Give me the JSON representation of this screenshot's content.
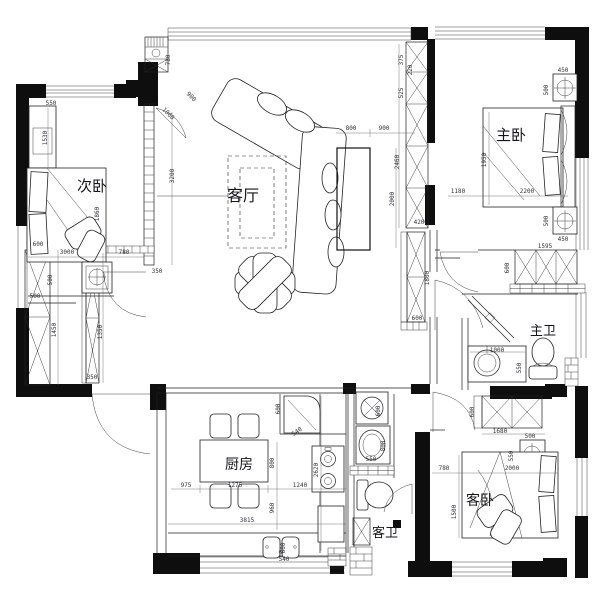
{
  "floorplan": {
    "drawing_type": "apartment-floor-plan",
    "rooms": [
      {
        "id": "ciwo",
        "label": "次卧",
        "x": 92,
        "y": 191,
        "size": 15
      },
      {
        "id": "keting",
        "label": "客厅",
        "x": 243,
        "y": 201,
        "size": 16
      },
      {
        "id": "zhuwo",
        "label": "主卧",
        "x": 511,
        "y": 140,
        "size": 15
      },
      {
        "id": "zhuwei",
        "label": "主卫",
        "x": 543,
        "y": 335,
        "size": 13
      },
      {
        "id": "chufang",
        "label": "厨房",
        "x": 239,
        "y": 469,
        "size": 14
      },
      {
        "id": "kewei",
        "label": "客卫",
        "x": 385,
        "y": 537,
        "size": 13
      },
      {
        "id": "kewo",
        "label": "客卧",
        "x": 480,
        "y": 505,
        "size": 14
      }
    ],
    "dimensions": [
      {
        "t": "550",
        "x": 51,
        "y": 105,
        "r": 0
      },
      {
        "t": "1530",
        "x": 47,
        "y": 138,
        "r": -90
      },
      {
        "t": "1860",
        "x": 99,
        "y": 214,
        "r": -90
      },
      {
        "t": "3000",
        "x": 67,
        "y": 254,
        "r": 0
      },
      {
        "t": "780",
        "x": 124,
        "y": 254,
        "r": 0
      },
      {
        "t": "500",
        "x": 52,
        "y": 280,
        "r": -90
      },
      {
        "t": "500",
        "x": 35,
        "y": 298,
        "r": 0
      },
      {
        "t": "600",
        "x": 38,
        "y": 246,
        "r": 0
      },
      {
        "t": "1450",
        "x": 56,
        "y": 330,
        "r": -90
      },
      {
        "t": "1350",
        "x": 102,
        "y": 332,
        "r": -90
      },
      {
        "t": "350",
        "x": 92,
        "y": 379,
        "r": 0
      },
      {
        "t": "3200",
        "x": 174,
        "y": 176,
        "r": -90
      },
      {
        "t": "350",
        "x": 157,
        "y": 273,
        "r": 0
      },
      {
        "t": "780",
        "x": 170,
        "y": 60,
        "r": -90
      },
      {
        "t": "900",
        "x": 190,
        "y": 98,
        "r": 45
      },
      {
        "t": "1060",
        "x": 167,
        "y": 115,
        "r": 45
      },
      {
        "t": "800",
        "x": 351,
        "y": 130,
        "r": 0
      },
      {
        "t": "900",
        "x": 384,
        "y": 130,
        "r": 0
      },
      {
        "t": "2460",
        "x": 399,
        "y": 162,
        "r": -90
      },
      {
        "t": "2000",
        "x": 394,
        "y": 199,
        "r": -90
      },
      {
        "t": "375",
        "x": 403,
        "y": 60,
        "r": -90
      },
      {
        "t": "525",
        "x": 403,
        "y": 93,
        "r": -90
      },
      {
        "t": "220",
        "x": 412,
        "y": 70,
        "r": -90
      },
      {
        "t": "420",
        "x": 419,
        "y": 224,
        "r": 0
      },
      {
        "t": "1800",
        "x": 429,
        "y": 278,
        "r": -90
      },
      {
        "t": "600",
        "x": 417,
        "y": 320,
        "r": 0
      },
      {
        "t": "450",
        "x": 563,
        "y": 72,
        "r": 0
      },
      {
        "t": "500",
        "x": 548,
        "y": 90,
        "r": -90
      },
      {
        "t": "1950",
        "x": 486,
        "y": 160,
        "r": -90
      },
      {
        "t": "1180",
        "x": 458,
        "y": 193,
        "r": 0
      },
      {
        "t": "2200",
        "x": 527,
        "y": 193,
        "r": 0
      },
      {
        "t": "500",
        "x": 548,
        "y": 221,
        "r": -90
      },
      {
        "t": "450",
        "x": 563,
        "y": 241,
        "r": 0
      },
      {
        "t": "1595",
        "x": 545,
        "y": 248,
        "r": 0
      },
      {
        "t": "600",
        "x": 509,
        "y": 268,
        "r": -90
      },
      {
        "t": "1000",
        "x": 497,
        "y": 352,
        "r": 0
      },
      {
        "t": "550",
        "x": 521,
        "y": 368,
        "r": -90
      },
      {
        "t": "600",
        "x": 474,
        "y": 412,
        "r": -90
      },
      {
        "t": "1680",
        "x": 500,
        "y": 433,
        "r": 0
      },
      {
        "t": "500",
        "x": 530,
        "y": 438,
        "r": 0
      },
      {
        "t": "550",
        "x": 513,
        "y": 456,
        "r": -90
      },
      {
        "t": "780",
        "x": 444,
        "y": 470,
        "r": 0
      },
      {
        "t": "2000",
        "x": 512,
        "y": 470,
        "r": 0
      },
      {
        "t": "1500",
        "x": 456,
        "y": 512,
        "r": -90
      },
      {
        "t": "600",
        "x": 280,
        "y": 409,
        "r": -90
      },
      {
        "t": "540",
        "x": 298,
        "y": 433,
        "r": -35
      },
      {
        "t": "800",
        "x": 274,
        "y": 463,
        "r": -90
      },
      {
        "t": "975",
        "x": 186,
        "y": 487,
        "r": 0
      },
      {
        "t": "1275",
        "x": 235,
        "y": 487,
        "r": 0
      },
      {
        "t": "1240",
        "x": 300,
        "y": 487,
        "r": 0
      },
      {
        "t": "960",
        "x": 274,
        "y": 508,
        "r": -90
      },
      {
        "t": "2620",
        "x": 318,
        "y": 470,
        "r": -90
      },
      {
        "t": "3815",
        "x": 247,
        "y": 522,
        "r": 0
      },
      {
        "t": "600",
        "x": 285,
        "y": 548,
        "r": -90
      },
      {
        "t": "540",
        "x": 284,
        "y": 561,
        "r": 0
      },
      {
        "t": "600",
        "x": 380,
        "y": 411,
        "r": -90
      },
      {
        "t": "800",
        "x": 385,
        "y": 446,
        "r": -90
      },
      {
        "t": "550",
        "x": 371,
        "y": 461,
        "r": 0
      }
    ]
  }
}
